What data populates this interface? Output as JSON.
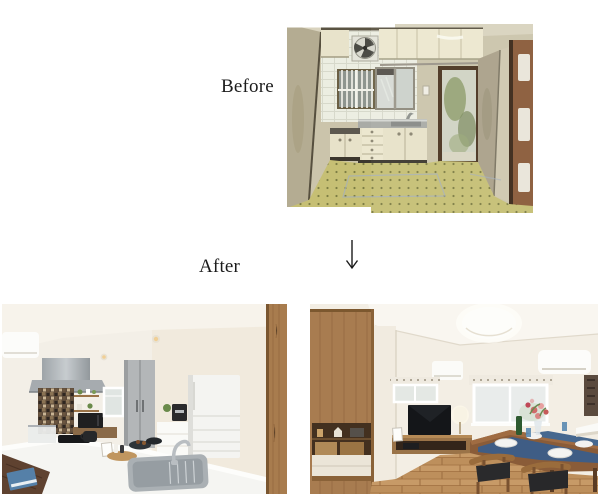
{
  "page": {
    "width": 600,
    "height": 499,
    "background_color": "#ffffff"
  },
  "comparison": {
    "before_label": "Before",
    "after_label": "After",
    "arrow": {
      "direction": "down",
      "color": "#1a1a1a"
    }
  },
  "photos": {
    "before": {
      "description": "Dated kitchen: cream upper cabinets, round exhaust fan on white tile, barred window, frosted sliding window, stainless sink counter with drawer unit, frosted back door with foliage, dingy beige walls, yellow-green checkered tile floor, reddish interior door at right; panorama stitched from two shots",
      "palette": {
        "wall": "#cbc4ab",
        "cabinets": "#eae5cd",
        "tile_wall": "#eceee2",
        "floor": "#c6bf74",
        "door_frame": "#4a3420",
        "right_door": "#8a5a38"
      }
    },
    "after_kitchen": {
      "description": "Renovated white kitchen: air conditioner, stainless range hood, dark mosaic backsplash, open shelves with plants, black microwave, small window, tall gray cabinet, white refrigerator, coffee maker, white island with stainless sink and faucet, wooden pillar at right, dark wood floor with blue magazine",
      "palette": {
        "walls": "#f3efe7",
        "hood": "#aab0b4",
        "mosaic": "#5d4b3a",
        "island": "#f5f5f2",
        "fridge": "#f4f4f1",
        "pillar": "#a87c4e"
      }
    },
    "after_living": {
      "description": "Renovated living-dining room: tall wooden cabinet with display niche, white wall corner, round ceiling light, two air conditioners, small and large windows with patterned valances, TV on wooden low board, table lamp, dining table with navy runner, white plates, green bottle, flowers, wooden chairs with dark seats, oak flooring, dark wall art and white shelf at right",
      "palette": {
        "walls": "#f3eee4",
        "wood_cabinet": "#a87c50",
        "floor": "#c79a67",
        "table": "#8a5c38",
        "runner": "#3f5d85"
      }
    }
  }
}
